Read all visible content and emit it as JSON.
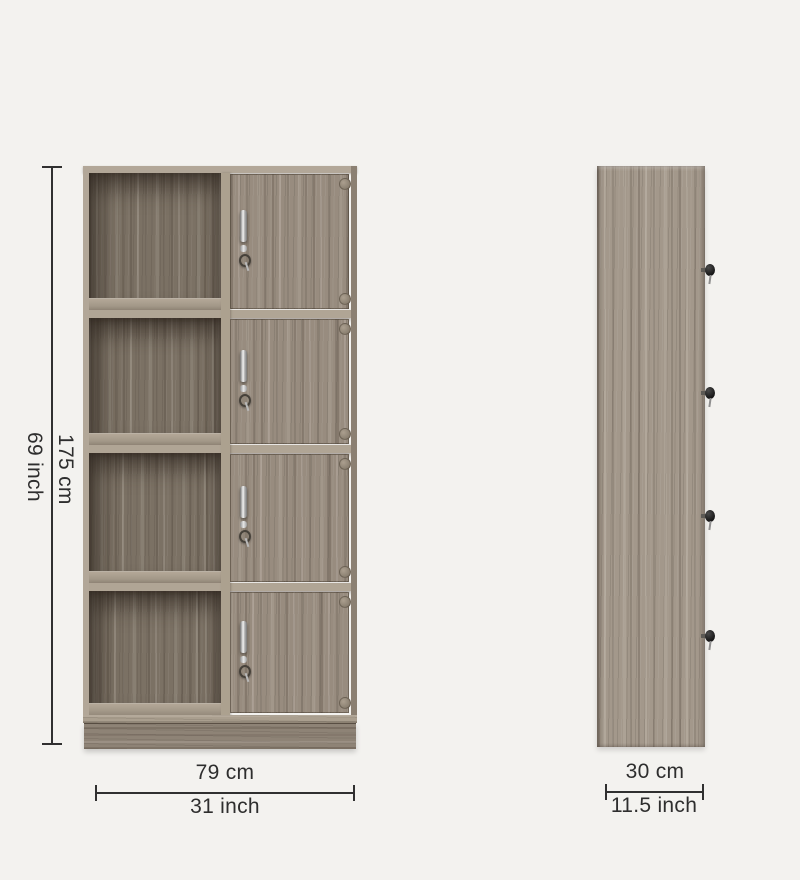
{
  "page": {
    "background_color": "#f3f2ef"
  },
  "annotations": {
    "line_color": "#303030",
    "text_color": "#2e2e2e",
    "front_height_cm": "175 cm",
    "front_height_inch": "69 inch",
    "front_width_cm": "79 cm",
    "front_width_inch": "31 inch",
    "side_depth_cm": "30 cm",
    "side_depth_inch": "11.5 inch"
  },
  "cabinet": {
    "front_view": {
      "open_compartments": 4,
      "locker_doors": 4,
      "door_fittings": [
        "chrome-handle",
        "lock-barrel",
        "hanging-key"
      ],
      "hinges_per_door": 2
    },
    "side_view": {
      "protruding_keys": 4
    },
    "colors": {
      "wood_face": "#988c7f",
      "wood_edge_light": "#b2a798",
      "wood_interior": "#7b7164",
      "wood_plinth": "#8e8376",
      "wood_side": "#a3988b",
      "handle_chrome": "#d9d9d9",
      "key_black": "#1c1c1c"
    }
  }
}
